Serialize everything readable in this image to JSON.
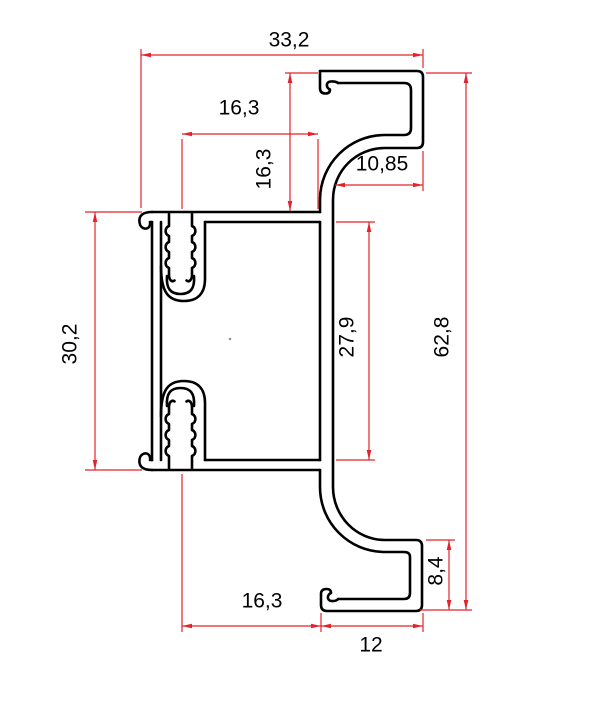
{
  "drawing": {
    "background_color": "#ffffff",
    "profile_color": "#000000",
    "dimension_color": "#e3232b",
    "text_color": "#000000",
    "dimensions": [
      {
        "name": "top-width",
        "value": "33,2",
        "orientation": "horizontal"
      },
      {
        "name": "top-slot-to-wall",
        "value": "16,3",
        "orientation": "horizontal"
      },
      {
        "name": "top-flange-height",
        "value": "16,3",
        "orientation": "vertical"
      },
      {
        "name": "top-hook-width",
        "value": "10,85",
        "orientation": "horizontal"
      },
      {
        "name": "body-height",
        "value": "30,2",
        "orientation": "vertical"
      },
      {
        "name": "body-inner-height",
        "value": "27,9",
        "orientation": "vertical"
      },
      {
        "name": "total-height",
        "value": "62,8",
        "orientation": "vertical"
      },
      {
        "name": "bottom-hook-height",
        "value": "8,4",
        "orientation": "vertical"
      },
      {
        "name": "bottom-slot-to-wall",
        "value": "16,3",
        "orientation": "horizontal"
      },
      {
        "name": "bottom-flange-width",
        "value": "12",
        "orientation": "horizontal"
      }
    ]
  }
}
